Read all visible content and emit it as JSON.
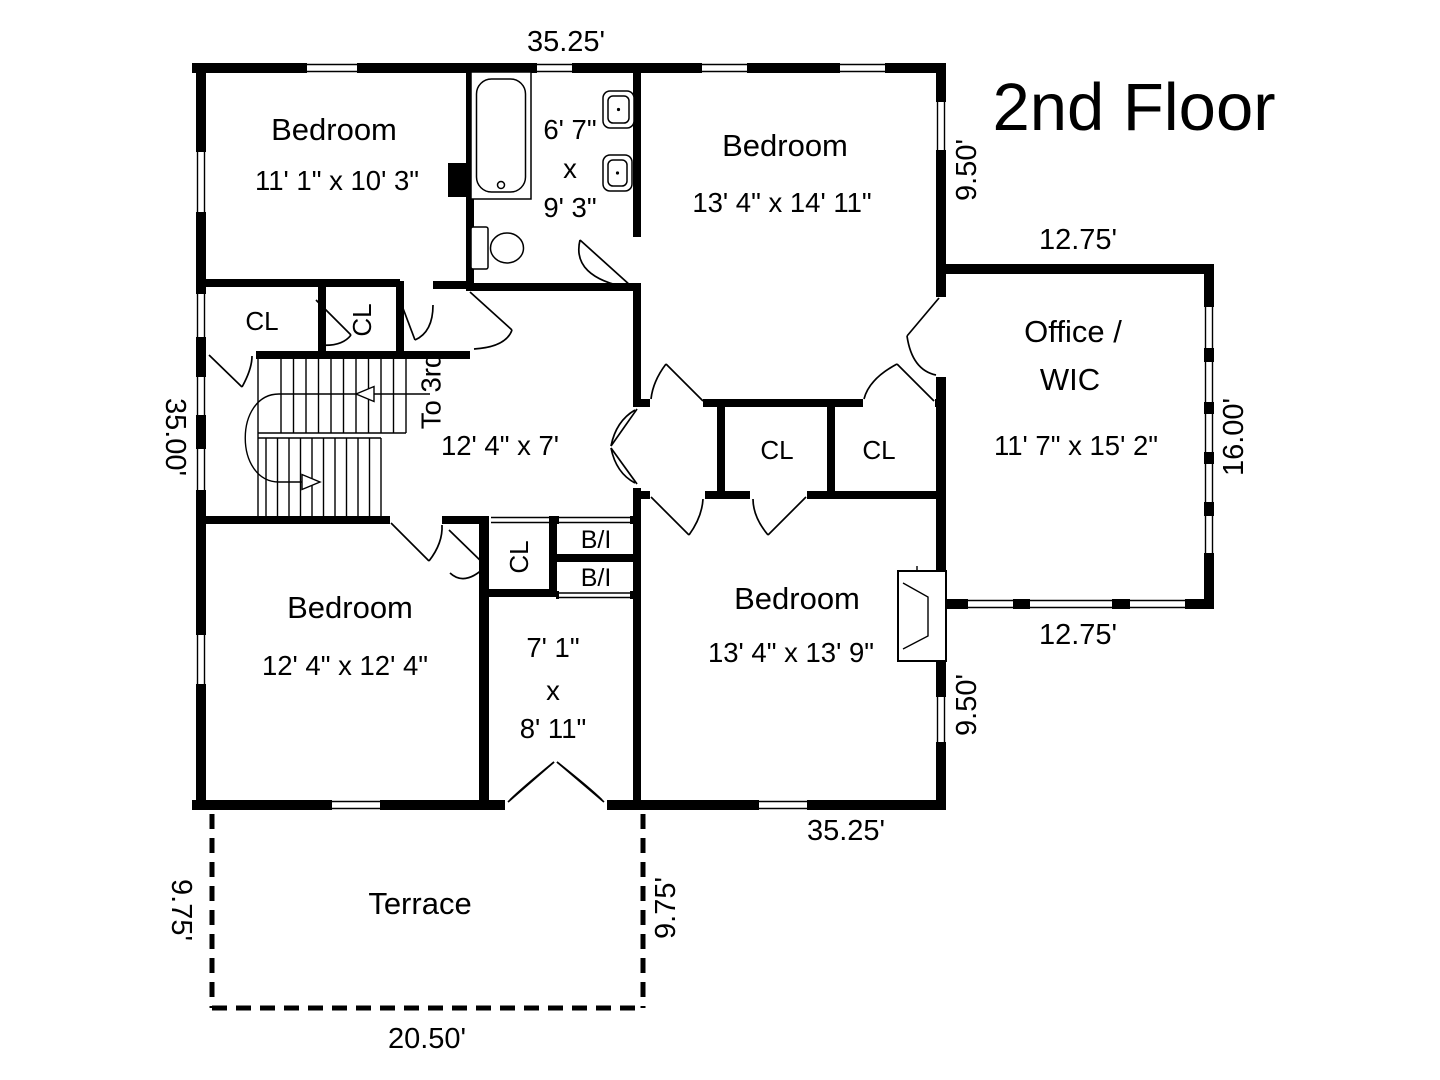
{
  "title": "2nd Floor",
  "colors": {
    "wall": "#000000",
    "background": "#ffffff"
  },
  "dimensions": {
    "top": "35.25'",
    "bottom": "35.25'",
    "left": "35.00'",
    "right_upper": "9.50'",
    "right_lower": "9.50'",
    "office_top": "12.75'",
    "office_bottom": "12.75'",
    "office_right": "16.00'",
    "terrace_left": "9.75'",
    "terrace_right": "9.75'",
    "terrace_bottom": "20.50'"
  },
  "rooms": {
    "bedroom_top_left": {
      "name": "Bedroom",
      "size": "11' 1\" x 10' 3\""
    },
    "bathroom": {
      "size_width": "6' 7\"",
      "size_sep": "x",
      "size_depth": "9' 3\""
    },
    "bedroom_top_right": {
      "name": "Bedroom",
      "size": "13' 4\" x 14' 11\""
    },
    "office_wic": {
      "name_line1": "Office /",
      "name_line2": "WIC",
      "size": "11' 7\" x 15' 2\""
    },
    "hall": {
      "size": "12' 4\" x 7'"
    },
    "bedroom_bottom_left": {
      "name": "Bedroom",
      "size": "12' 4\" x 12' 4\""
    },
    "inner_hall": {
      "size_width": "7' 1\"",
      "size_sep": "x",
      "size_depth": "8' 11\""
    },
    "bedroom_bottom_right": {
      "name": "Bedroom",
      "size": "13' 4\" x 13' 9\""
    },
    "terrace": {
      "name": "Terrace"
    }
  },
  "labels": {
    "closet": "CL",
    "built_in": "B/I",
    "stairs_to": "To 3rd"
  }
}
